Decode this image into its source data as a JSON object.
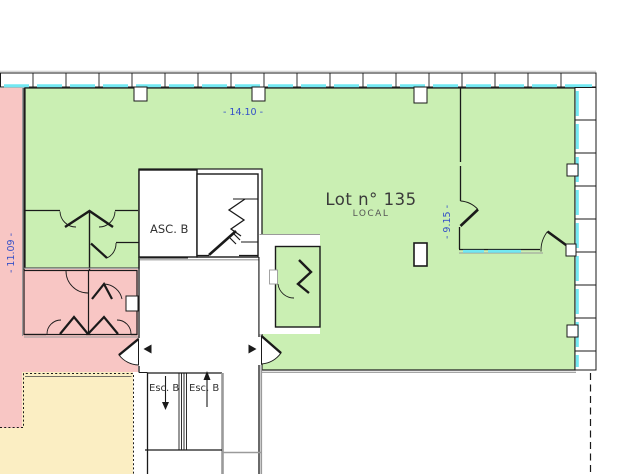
{
  "plan": {
    "lot": {
      "label": "Lot n° 135",
      "type": "LOCAL"
    },
    "elevator": {
      "label": "ASC. B"
    },
    "stairs": {
      "left_label": "Esc. B",
      "right_label": "Esc. B"
    },
    "dimensions": {
      "top_width": "- 14.10 -",
      "right_height": "- 9.15 -",
      "left_height": "- 11.09 -"
    }
  },
  "colors": {
    "lot_green": "#caefb3",
    "adjacent_pink": "#f8c6c4",
    "adjacent_yellow": "#fbeec3",
    "window_cyan": "#72e8f2",
    "dimension_blue": "#3450c8"
  }
}
